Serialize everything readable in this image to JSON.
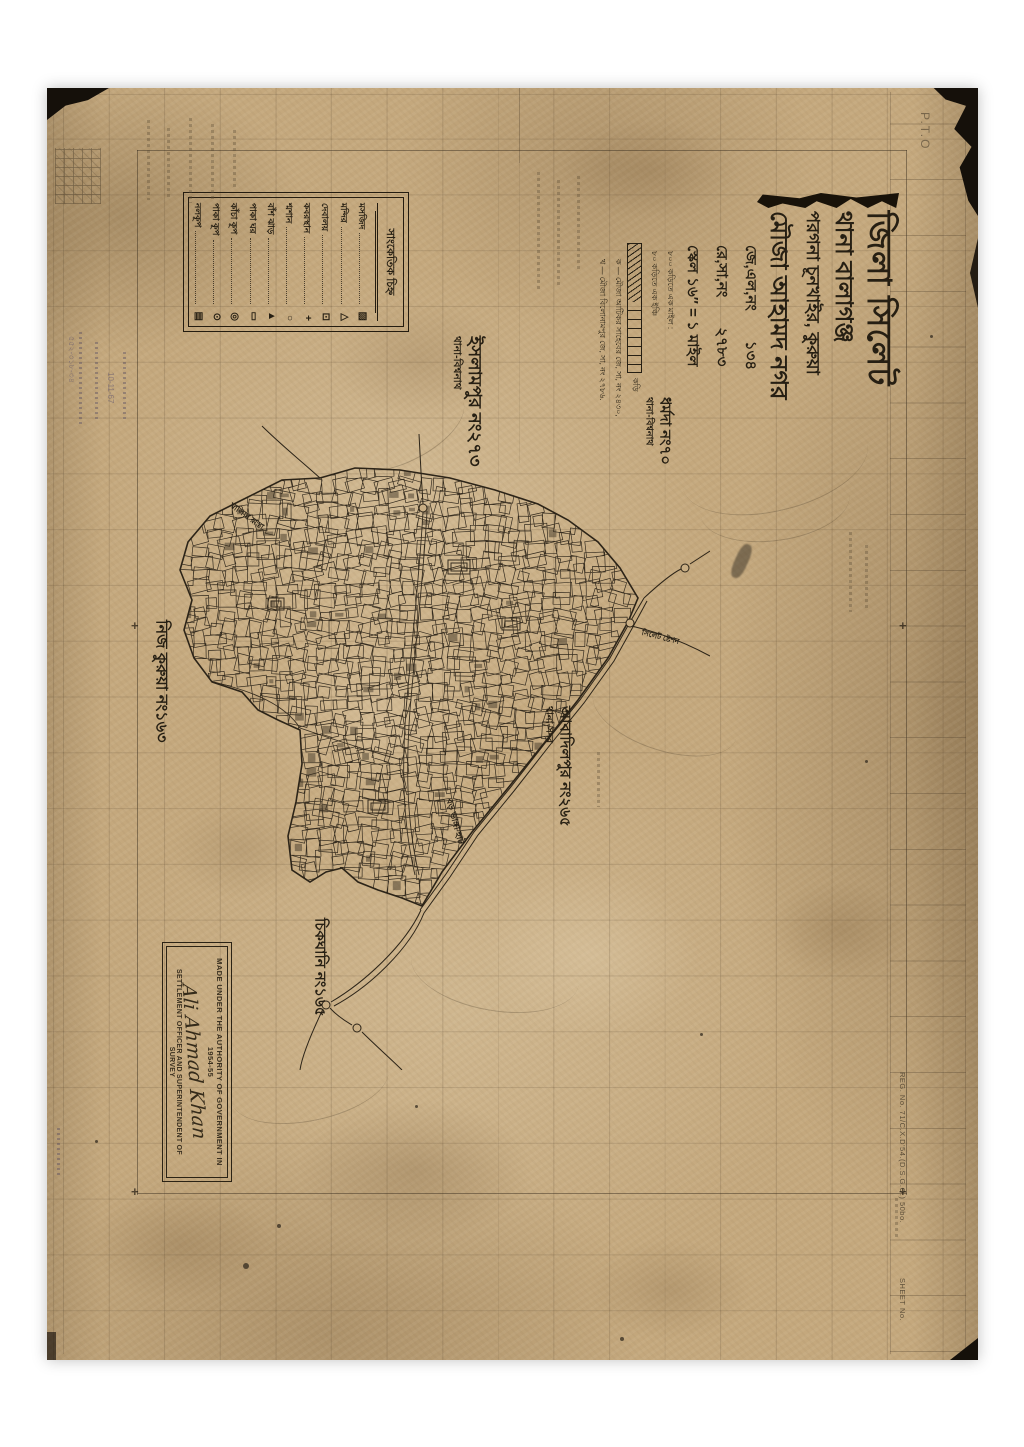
{
  "sheet": {
    "pto": "P.T.O",
    "reg_no": "REG. No. 71/C.X.D'54.(D.S.G.O.) 50bo.",
    "sheet_no": "SHEET No."
  },
  "title_block": {
    "district": "জিলা সিলেট",
    "thana": "থানা  বালাগঞ্জ",
    "pargana": "পরগনা  চূনখাইর, কুরুয়া",
    "mouza": "মৌজা  আহামদ নগর",
    "jl_label": "জে,এল,নং",
    "jl_value": "১৩৪",
    "rs_label": "রে,সা,নং",
    "rs_value": "২৭৮৩",
    "scale_line": "স্কেল ১৬″ = ১ মাইল",
    "scale_note1": "৮০০ কড়িতে এক মাইল :",
    "scale_note2": "৮০ কড়িতে এক ইঞ্চি",
    "scalebar_unit": "কড়ি",
    "footnote1": "ক — মৌজা আটিকর সাহেবের জে, সা, নং ২৪৩০,",
    "footnote2": "খ — মৌজা বিলোনামপুর জে, সা, নং ২৭৮৬."
  },
  "legend": {
    "header": "সাংকেতিক চিহ্ন",
    "items": [
      {
        "label": "মসজিদ",
        "symbol": "▨"
      },
      {
        "label": "মন্দির",
        "symbol": "△"
      },
      {
        "label": "দেবালয়",
        "symbol": "⊡"
      },
      {
        "label": "কবরস্থান",
        "symbol": "+"
      },
      {
        "label": "শ্মশান",
        "symbol": "○"
      },
      {
        "label": "বাঁশ ঝাড়",
        "symbol": "▲"
      },
      {
        "label": "পাকা ঘর",
        "symbol": "▭"
      },
      {
        "label": "কাঁচা কূপ",
        "symbol": "◎"
      },
      {
        "label": "পাকা কূপ",
        "symbol": "⊙"
      },
      {
        "label": "নলকূপ",
        "symbol": "▤"
      }
    ]
  },
  "neighbors": {
    "islampur": {
      "name": "ইসলামপুর নং২৭৩",
      "thana": "থানা-বিশ্বনাথ"
    },
    "dharmada": {
      "name": "ধর্মদা নং৭০",
      "thana": "থানা-বিশ্বনাথ"
    },
    "nij_kurua": {
      "name": "নিজ কুরুয়া নং১৬৩"
    },
    "abadilpur": {
      "name": "আবাদিলপুর নং২৬৫",
      "thana": "থানা-সদর"
    },
    "chikghani": {
      "name": "চিকঘানি নং১৬৫"
    }
  },
  "roads": {
    "station_road": "সিলেট ষ্টেশন",
    "khalia_road": "খালিয়া রাস্তা",
    "hat_road": "বড় ভাঙ্গা হাট"
  },
  "stamp": {
    "line1": "MADE UNDER THE AUTHORITY OF GOVERNMENT IN 1954-55",
    "signature": "Ali Ahmad Khan",
    "line2": "SETTLEMENT OFFICER AND SUPERINTENDENT OF SURVEY"
  },
  "pencil": {
    "note1": "৫৫২-৩১৮-৩৪",
    "note2": "10-11-67"
  }
}
